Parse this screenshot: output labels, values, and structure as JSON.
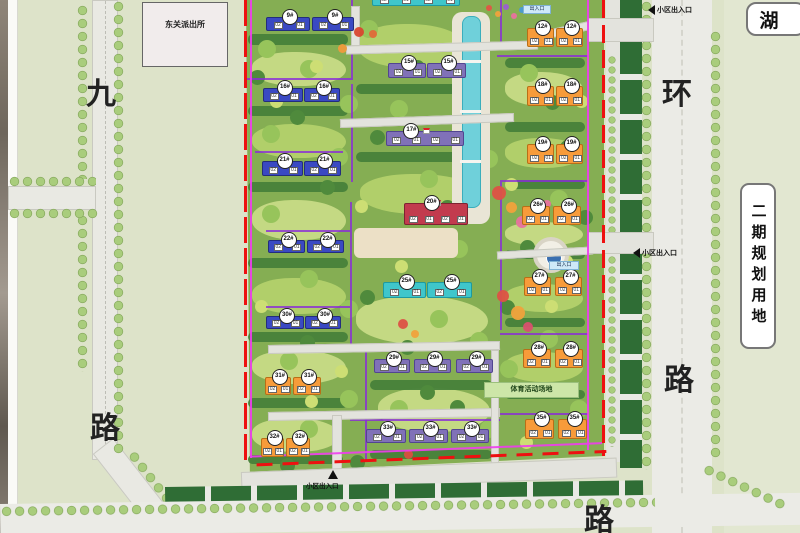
{
  "map": {
    "police_station": "东关派出所",
    "lake": "湖",
    "phase2_plot": "二期规划用地",
    "sports_ground": "体育活动场地",
    "road_left": {
      "top_char": "九",
      "bottom_char": "路"
    },
    "road_right": {
      "top_char": "环",
      "bottom_char": "路"
    },
    "road_bottom_char": "路",
    "entrance_top": "小区出入口",
    "entrance_middle": "小区出入口",
    "entrance_bottom": "小区出入口",
    "gate_box_top": "出入口",
    "gate_box_middle": "出入口"
  },
  "palette": {
    "building_blue": "#3a49c3",
    "building_purple": "#8071b8",
    "building_cyan": "#3fc6cb",
    "building_orange": "#f79b3a",
    "building_red": "#c23b4e",
    "boundary_red_line": "#ee1010",
    "boundary_magenta_line": "#f03cf0",
    "block_line_purple": "#8a2bd9",
    "water": "#6fd0da"
  },
  "unit_labels": [
    "02",
    "01"
  ],
  "buildings": [
    {
      "label": "9#",
      "x": 266,
      "y": 17,
      "w": 44,
      "h": 14,
      "c": "blue"
    },
    {
      "label": "9#",
      "x": 312,
      "y": 17,
      "w": 42,
      "h": 14,
      "c": "blue"
    },
    {
      "label": "",
      "x": 372,
      "y": -6,
      "w": 88,
      "h": 12,
      "c": "cyan",
      "u": 4
    },
    {
      "label": "15#",
      "x": 388,
      "y": 63,
      "w": 38,
      "h": 15,
      "c": "purple"
    },
    {
      "label": "15#",
      "x": 427,
      "y": 63,
      "w": 39,
      "h": 15,
      "c": "purple"
    },
    {
      "label": "12#",
      "x": 527,
      "y": 28,
      "w": 27,
      "h": 19,
      "c": "orange"
    },
    {
      "label": "12#",
      "x": 556,
      "y": 28,
      "w": 27,
      "h": 19,
      "c": "orange"
    },
    {
      "label": "16#",
      "x": 263,
      "y": 88,
      "w": 40,
      "h": 14,
      "c": "blue"
    },
    {
      "label": "16#",
      "x": 304,
      "y": 88,
      "w": 36,
      "h": 14,
      "c": "blue"
    },
    {
      "label": "18#",
      "x": 527,
      "y": 86,
      "w": 27,
      "h": 20,
      "c": "orange"
    },
    {
      "label": "18#",
      "x": 556,
      "y": 86,
      "w": 27,
      "h": 20,
      "c": "orange"
    },
    {
      "label": "17#",
      "x": 386,
      "y": 131,
      "w": 78,
      "h": 15,
      "c": "purple",
      "u": 4,
      "bx": 0.3
    },
    {
      "label": "19#",
      "x": 527,
      "y": 144,
      "w": 27,
      "h": 20,
      "c": "orange"
    },
    {
      "label": "19#",
      "x": 556,
      "y": 144,
      "w": 27,
      "h": 20,
      "c": "orange"
    },
    {
      "label": "21#",
      "x": 262,
      "y": 161,
      "w": 41,
      "h": 15,
      "c": "blue"
    },
    {
      "label": "21#",
      "x": 304,
      "y": 161,
      "w": 37,
      "h": 15,
      "c": "blue"
    },
    {
      "label": "20#",
      "x": 404,
      "y": 203,
      "w": 64,
      "h": 22,
      "c": "red",
      "u": 4,
      "bx": 0.4
    },
    {
      "label": "26#",
      "x": 522,
      "y": 206,
      "w": 28,
      "h": 19,
      "c": "orange"
    },
    {
      "label": "26#",
      "x": 553,
      "y": 206,
      "w": 28,
      "h": 19,
      "c": "orange"
    },
    {
      "label": "22#",
      "x": 268,
      "y": 240,
      "w": 37,
      "h": 13,
      "c": "blue"
    },
    {
      "label": "22#",
      "x": 307,
      "y": 240,
      "w": 37,
      "h": 13,
      "c": "blue"
    },
    {
      "label": "25#",
      "x": 383,
      "y": 282,
      "w": 43,
      "h": 16,
      "c": "cyan"
    },
    {
      "label": "25#",
      "x": 427,
      "y": 282,
      "w": 45,
      "h": 16,
      "c": "cyan"
    },
    {
      "label": "27#",
      "x": 524,
      "y": 277,
      "w": 27,
      "h": 19,
      "c": "orange"
    },
    {
      "label": "27#",
      "x": 555,
      "y": 277,
      "w": 27,
      "h": 19,
      "c": "orange"
    },
    {
      "label": "30#",
      "x": 266,
      "y": 316,
      "w": 38,
      "h": 13,
      "c": "blue"
    },
    {
      "label": "30#",
      "x": 305,
      "y": 316,
      "w": 36,
      "h": 13,
      "c": "blue"
    },
    {
      "label": "29#",
      "x": 374,
      "y": 359,
      "w": 36,
      "h": 14,
      "c": "purple"
    },
    {
      "label": "29#",
      "x": 414,
      "y": 359,
      "w": 37,
      "h": 14,
      "c": "purple"
    },
    {
      "label": "29#",
      "x": 456,
      "y": 359,
      "w": 37,
      "h": 14,
      "c": "purple"
    },
    {
      "label": "28#",
      "x": 523,
      "y": 349,
      "w": 28,
      "h": 19,
      "c": "orange"
    },
    {
      "label": "28#",
      "x": 555,
      "y": 349,
      "w": 28,
      "h": 19,
      "c": "orange"
    },
    {
      "label": "31#",
      "x": 265,
      "y": 377,
      "w": 26,
      "h": 18,
      "c": "orange"
    },
    {
      "label": "31#",
      "x": 293,
      "y": 377,
      "w": 28,
      "h": 18,
      "c": "orange"
    },
    {
      "label": "35#",
      "x": 525,
      "y": 419,
      "w": 29,
      "h": 20,
      "c": "orange"
    },
    {
      "label": "35#",
      "x": 558,
      "y": 419,
      "w": 29,
      "h": 20,
      "c": "orange"
    },
    {
      "label": "33#",
      "x": 366,
      "y": 429,
      "w": 40,
      "h": 14,
      "c": "purple"
    },
    {
      "label": "33#",
      "x": 409,
      "y": 429,
      "w": 39,
      "h": 14,
      "c": "purple"
    },
    {
      "label": "33#",
      "x": 451,
      "y": 429,
      "w": 38,
      "h": 14,
      "c": "purple"
    },
    {
      "label": "32#",
      "x": 261,
      "y": 438,
      "w": 23,
      "h": 19,
      "c": "orange"
    },
    {
      "label": "32#",
      "x": 286,
      "y": 438,
      "w": 24,
      "h": 19,
      "c": "orange"
    }
  ]
}
